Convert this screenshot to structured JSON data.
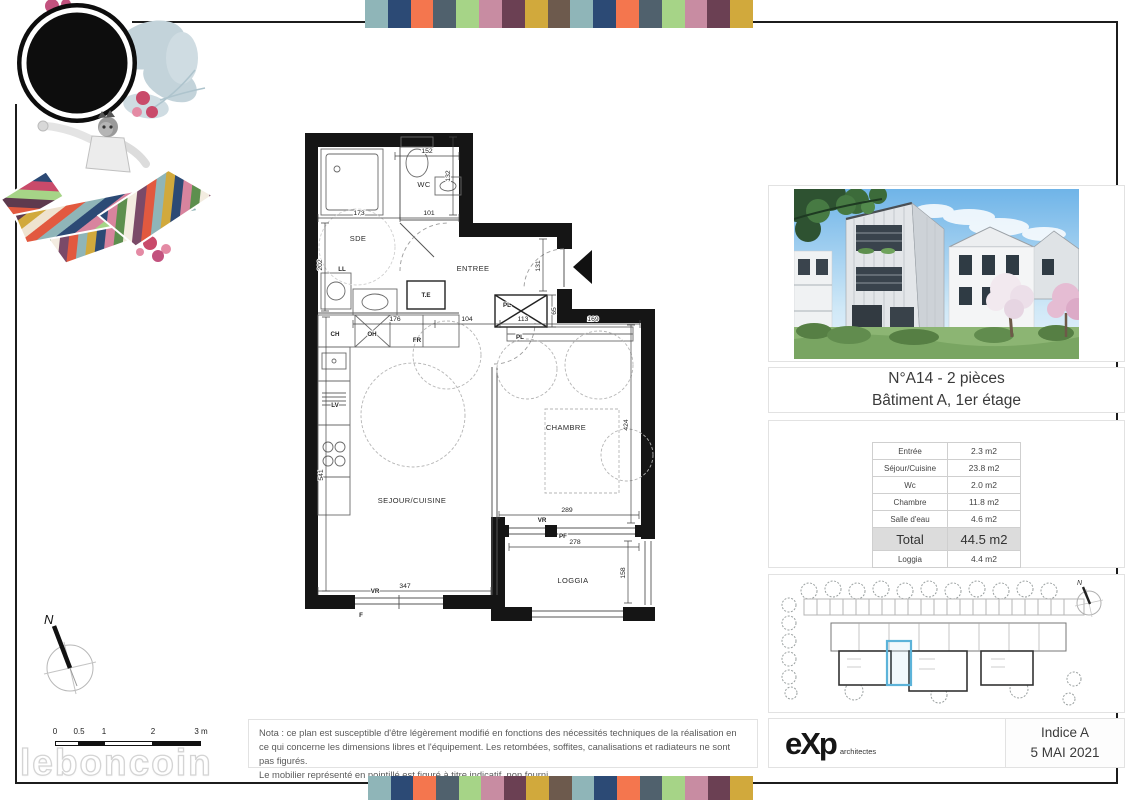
{
  "banner": {
    "colors": [
      "#8fb5b8",
      "#2c4a75",
      "#f4764e",
      "#50616d",
      "#a6d487",
      "#c88ca2",
      "#6b4053",
      "#d1a93c",
      "#6d5a4d"
    ]
  },
  "unit": {
    "title_line1": "N°A14 - 2 pièces",
    "title_line2": "Bâtiment A, 1er étage"
  },
  "areas": {
    "rows": [
      {
        "label": "Entrée",
        "value": "2.3 m2",
        "style": "normal"
      },
      {
        "label": "Séjour/Cuisine",
        "value": "23.8 m2",
        "style": "normal"
      },
      {
        "label": "Wc",
        "value": "2.0 m2",
        "style": "normal"
      },
      {
        "label": "Chambre",
        "value": "11.8 m2",
        "style": "normal"
      },
      {
        "label": "Salle d'eau",
        "value": "4.6 m2",
        "style": "normal"
      },
      {
        "label": "Total",
        "value": "44.5 m2",
        "style": "total"
      },
      {
        "label": "Loggia",
        "value": "4.4 m2",
        "style": "normal"
      }
    ]
  },
  "note": {
    "text1": "Nota : ce plan est susceptible d'être légèrement modifié en fonctions des nécessités techniques de la réalisation en ce qui concerne les dimensions libres et l'équipement. Les retombées, soffites, canalisations et radiateurs ne sont pas figurés.",
    "text2": "Le mobilier représenté en pointillé est figuré à titre indicatif, non fourni."
  },
  "titleblock": {
    "firm": "eXp",
    "firm_suffix": "architectes",
    "indice": "Indice A",
    "date": "5 MAI 2021"
  },
  "scalebar": {
    "labels": [
      "0",
      "0.5",
      "1",
      "2",
      "3 m"
    ]
  },
  "compass": {
    "label": "N"
  },
  "watermark": {
    "text": "leboncoin"
  },
  "plan": {
    "rooms": [
      {
        "t": "WC",
        "x": 129,
        "y": 62
      },
      {
        "t": "SDE",
        "x": 63,
        "y": 116
      },
      {
        "t": "ENTREE",
        "x": 178,
        "y": 146
      },
      {
        "t": "CHAMBRE",
        "x": 271,
        "y": 305
      },
      {
        "t": "SEJOUR/CUISINE",
        "x": 117,
        "y": 378
      },
      {
        "t": "LOGGIA",
        "x": 278,
        "y": 458
      }
    ],
    "fixtures": [
      {
        "t": "T.E",
        "x": 131,
        "y": 172
      },
      {
        "t": "PL",
        "x": 212,
        "y": 182
      },
      {
        "t": "PL",
        "x": 225,
        "y": 214
      },
      {
        "t": "LL",
        "x": 47,
        "y": 146
      },
      {
        "t": "CH",
        "x": 40,
        "y": 211
      },
      {
        "t": "OH",
        "x": 77,
        "y": 211
      },
      {
        "t": "FR",
        "x": 122,
        "y": 217
      },
      {
        "t": "LV",
        "x": 40,
        "y": 282
      },
      {
        "t": "VR",
        "x": 247,
        "y": 397
      },
      {
        "t": "PF",
        "x": 268,
        "y": 413
      },
      {
        "t": "VR",
        "x": 80,
        "y": 468
      },
      {
        "t": "F",
        "x": 66,
        "y": 492
      }
    ],
    "dims": [
      {
        "t": "152",
        "x": 132,
        "y": 28
      },
      {
        "t": "132",
        "x": 155,
        "y": 51,
        "r": -90
      },
      {
        "t": "173",
        "x": 64,
        "y": 90
      },
      {
        "t": "101",
        "x": 134,
        "y": 90
      },
      {
        "t": "202",
        "x": 27,
        "y": 140,
        "r": -90
      },
      {
        "t": "131",
        "x": 245,
        "y": 141,
        "r": -90
      },
      {
        "t": "176",
        "x": 100,
        "y": 196
      },
      {
        "t": "104",
        "x": 172,
        "y": 196
      },
      {
        "t": "113",
        "x": 228,
        "y": 196
      },
      {
        "t": "169",
        "x": 298,
        "y": 196
      },
      {
        "t": "65",
        "x": 261,
        "y": 186,
        "r": -90
      },
      {
        "t": "424",
        "x": 333,
        "y": 300,
        "r": -90
      },
      {
        "t": "541",
        "x": 28,
        "y": 350,
        "r": -90
      },
      {
        "t": "289",
        "x": 272,
        "y": 387
      },
      {
        "t": "278",
        "x": 280,
        "y": 419
      },
      {
        "t": "158",
        "x": 330,
        "y": 448,
        "r": -90
      },
      {
        "t": "347",
        "x": 110,
        "y": 463
      }
    ]
  }
}
